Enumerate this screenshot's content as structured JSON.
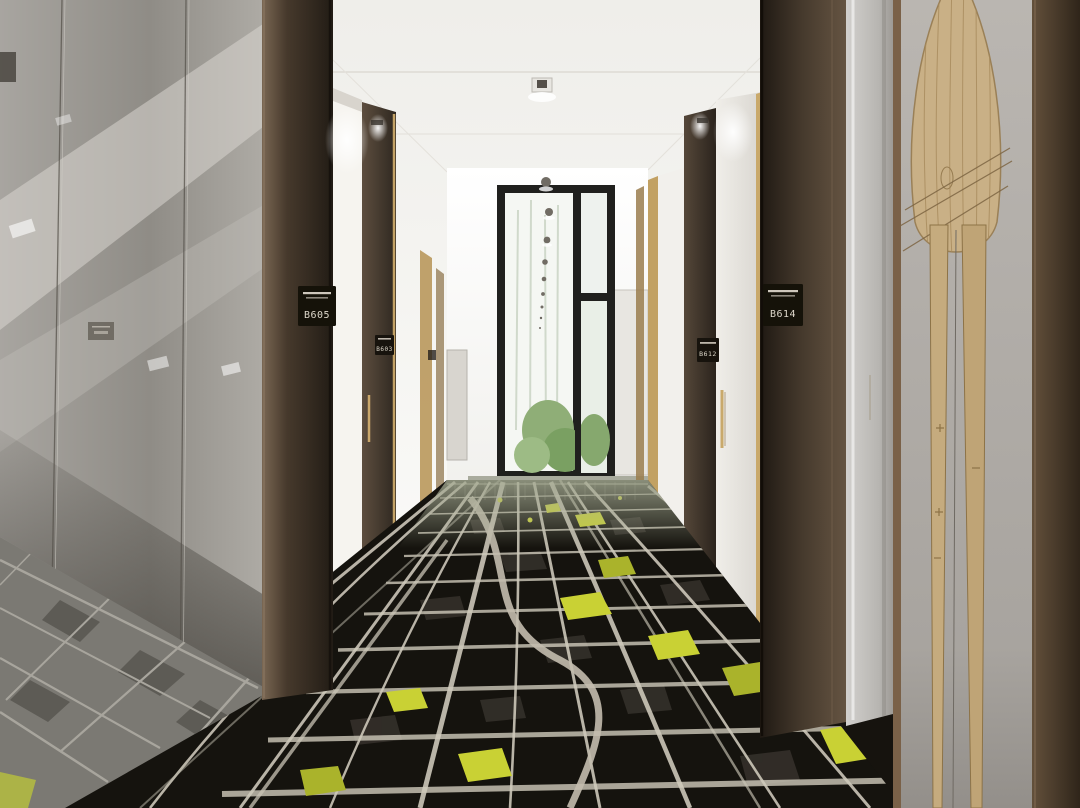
{
  "plates": [
    {
      "number": "B605"
    },
    {
      "number": "B603"
    },
    {
      "number": "B614"
    },
    {
      "number": "B612"
    }
  ],
  "colors": {
    "carpet_black": "#17140f",
    "street_white": "#d6d1c2",
    "park_yellow": "#c9d134",
    "column_brown": "#4a3e31",
    "gold_trim": "#c3a266",
    "wood_art": "#c9b086",
    "glass_gray": "#a3a09b",
    "ceiling_white": "#f4f3f0",
    "window_green": "#8fae77"
  }
}
